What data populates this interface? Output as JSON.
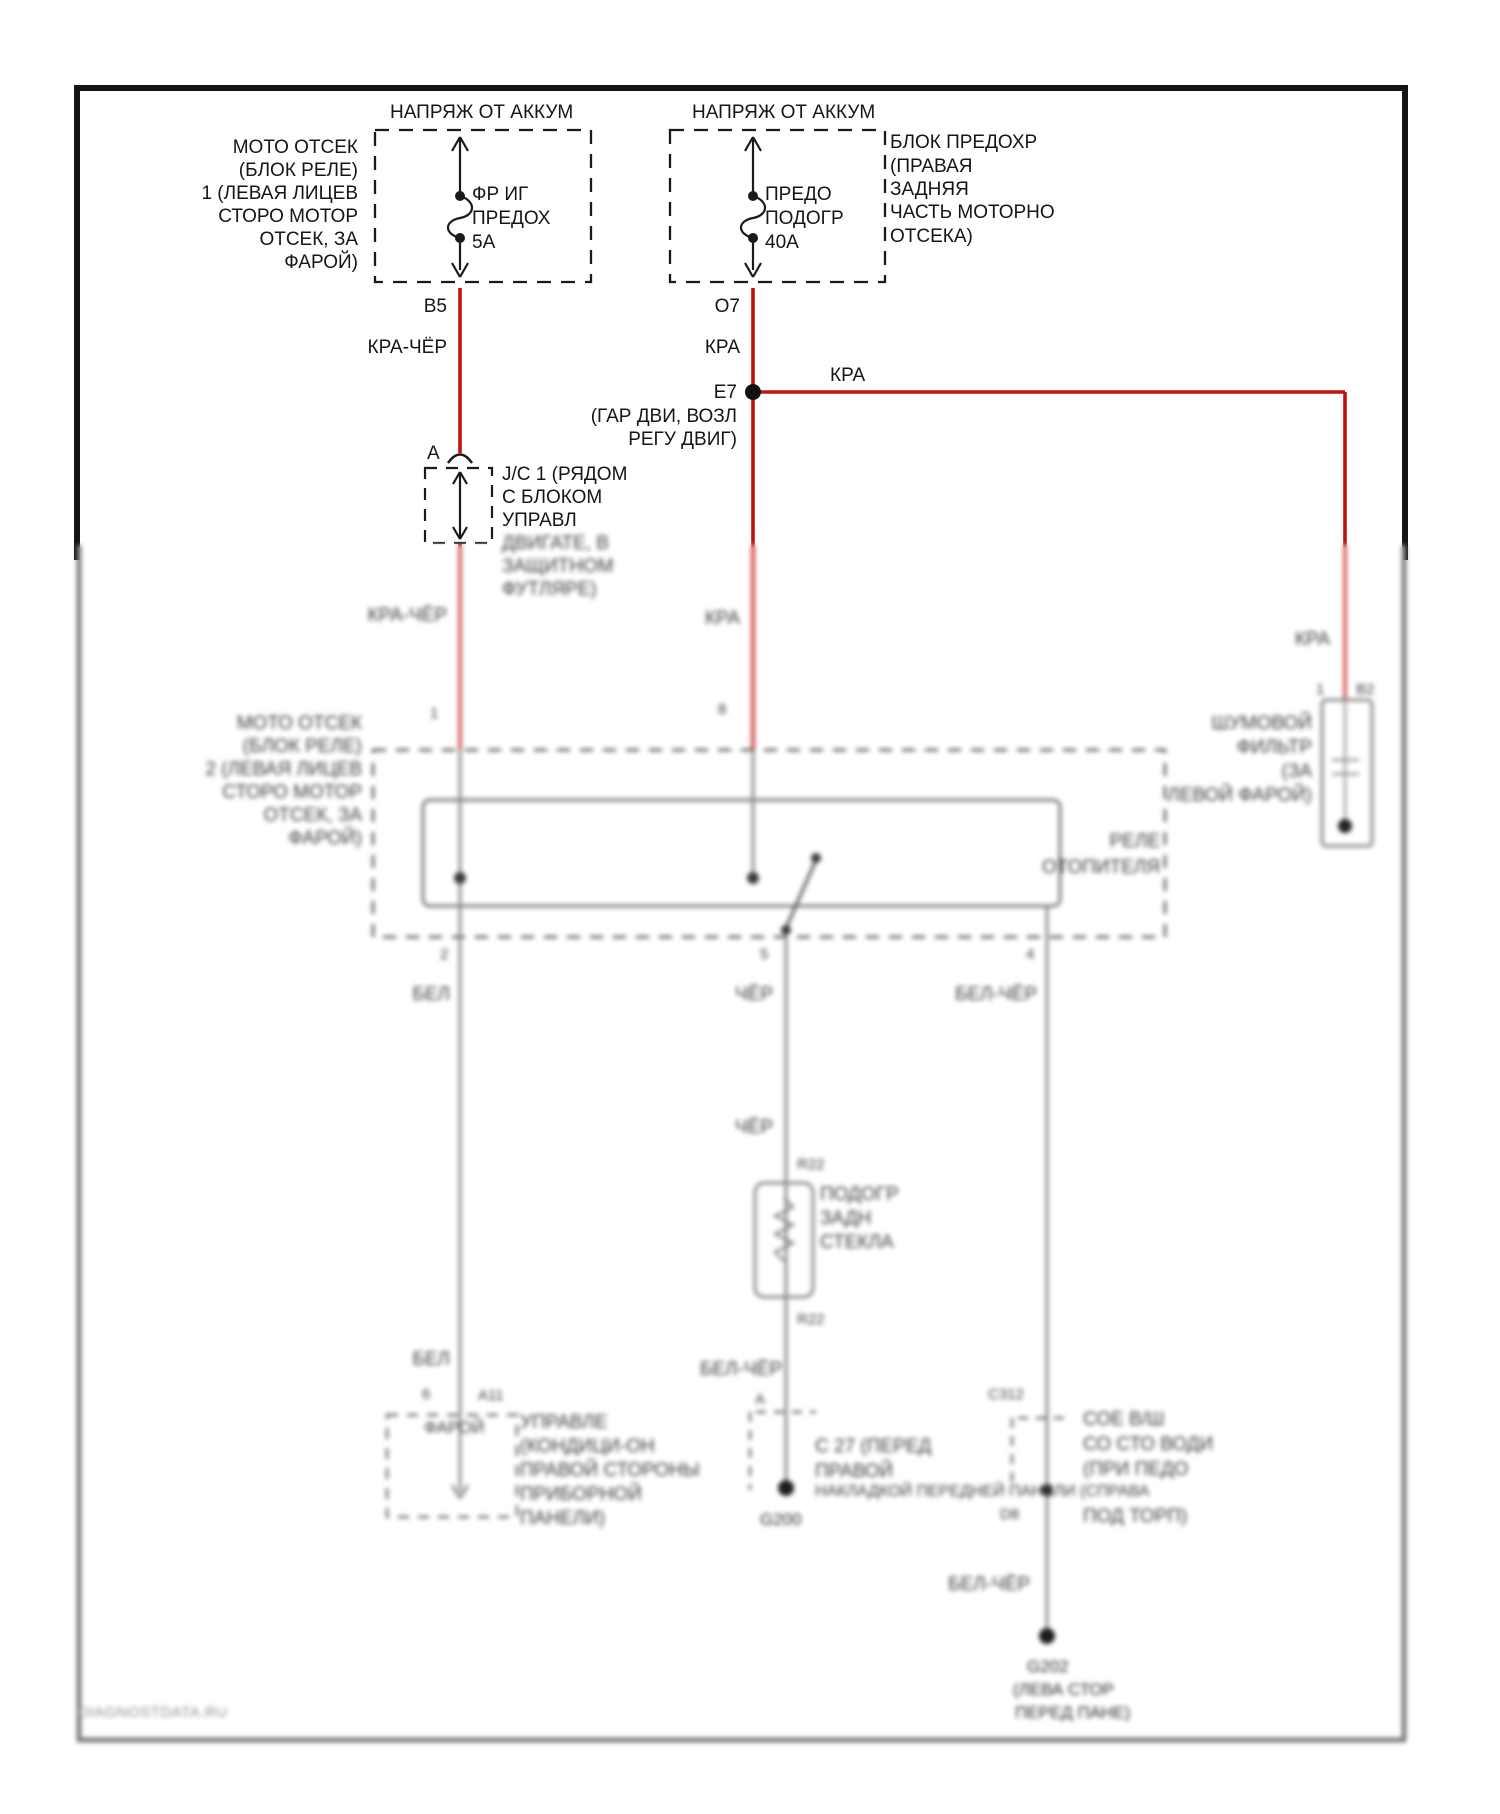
{
  "watermark": "DIAGNOSTDATA.RU",
  "sharp": {
    "batt_left": "НАПРЯЖ ОТ АККУМ",
    "batt_right": "НАПРЯЖ ОТ АККУМ",
    "fusebox1_label": [
      "МОТО ОТСЕК",
      "(БЛОК РЕЛЕ)",
      "1 (ЛЕВАЯ ЛИЦЕВ",
      "СТОРО МОТОР",
      "ОТСЕК, ЗА",
      "ФАРОЙ)"
    ],
    "fuse1": [
      "ФР ИГ",
      "ПРЕДОХ",
      "5А"
    ],
    "fusebox2_label": [
      "БЛОК ПРЕДОХР",
      "(ПРАВАЯ",
      "ЗАДНЯЯ",
      "ЧАСТЬ МОТОРНО",
      "ОТСЕКА)"
    ],
    "fuse2": [
      "ПРЕДО",
      "ПОДОГР",
      "40А"
    ],
    "pin_b5": "B5",
    "wire_kra_cher": "КРА-ЧЁР",
    "pin_o7": "O7",
    "wire_kra": "КРА",
    "pin_e7": "E7",
    "wire_kra_branch": "КРА",
    "e7_note": [
      "(ГАР ДВИ, ВОЗЛ",
      "РЕГУ ДВИГ)"
    ],
    "pin_a": "А",
    "jc_label": [
      "J/C 1 (РЯДОМ",
      "С БЛОКОМ",
      "УПРАВЛ"
    ]
  },
  "blur": {
    "jc_label2": [
      "ДВИГАТЕ, В",
      "ЗАЩИТНОМ",
      "ФУТЛЯРЕ)"
    ],
    "wire_kra_cher": "КРА-ЧЁР",
    "wire_kra_c": "КРА",
    "wire_kra_r": "КРА",
    "pin_1": "1",
    "pin_8": "8",
    "filter_pin1": "1",
    "filter_pin2": "B2",
    "filter_label": [
      "ШУМОВОЙ",
      "ФИЛЬТР",
      "(ЗА",
      "ЛЕВОЙ ФАРОЙ)"
    ],
    "relay_box_label": [
      "МОТО ОТСЕК",
      "(БЛОК РЕЛЕ)",
      "2 (ЛЕВАЯ ЛИЦЕВ",
      "СТОРО МОТОР",
      "ОТСЕК, ЗА",
      "ФАРОЙ)"
    ],
    "relay_name": [
      "РЕЛЕ",
      "ОТОПИТЕЛЯ"
    ],
    "relay_pins": [
      "2",
      "5",
      "4"
    ],
    "wire_bel": "БЕЛ",
    "wire_cher": "ЧЁР",
    "wire_bel_cher": "БЕЛ-ЧЁР",
    "wire_cher2": "ЧЁР",
    "pin_r22_top": "R22",
    "pin_r22_bot": "R22",
    "heater_label": [
      "ПОДОГР",
      "ЗАДН",
      "СТЕКЛА"
    ],
    "wire_bel_cher2": "БЕЛ-ЧЁР",
    "pin_a2": "А",
    "gnd_center": "G200",
    "conn_center_label": [
      "С 27 (ПЕРЕД",
      "ПРАВОЙ",
      "НАКЛАДКОЙ ПЕРЕДНЕЙ ПАНЕЛИ (СПРАВА"
    ],
    "wire_bel2": "БЕЛ",
    "pin_6": "6",
    "pin_a11": "А11",
    "conn_left_inner": "ФАРОЙ",
    "conn_left_label": [
      "УПРАВЛЕ",
      "(КОНДИЦИ-ОН",
      "ПРАВОЙ СТОРОНЫ",
      "ПРИБОРНОЙ",
      "ПАНЕЛИ)"
    ],
    "pin_c312": "С312",
    "pin_d8": "D8",
    "conn_right_label": [
      "СОЕ В/Ш",
      "СО СТО ВОДИ",
      "(ПРИ ПЕДО",
      "ПОД ТОРП)"
    ],
    "wire_bel_cher3": "БЕЛ-ЧЁР",
    "gnd_right": [
      "G202",
      "(ЛЕВА СТОР",
      "ПЕРЕД ПАНЕ)"
    ]
  }
}
